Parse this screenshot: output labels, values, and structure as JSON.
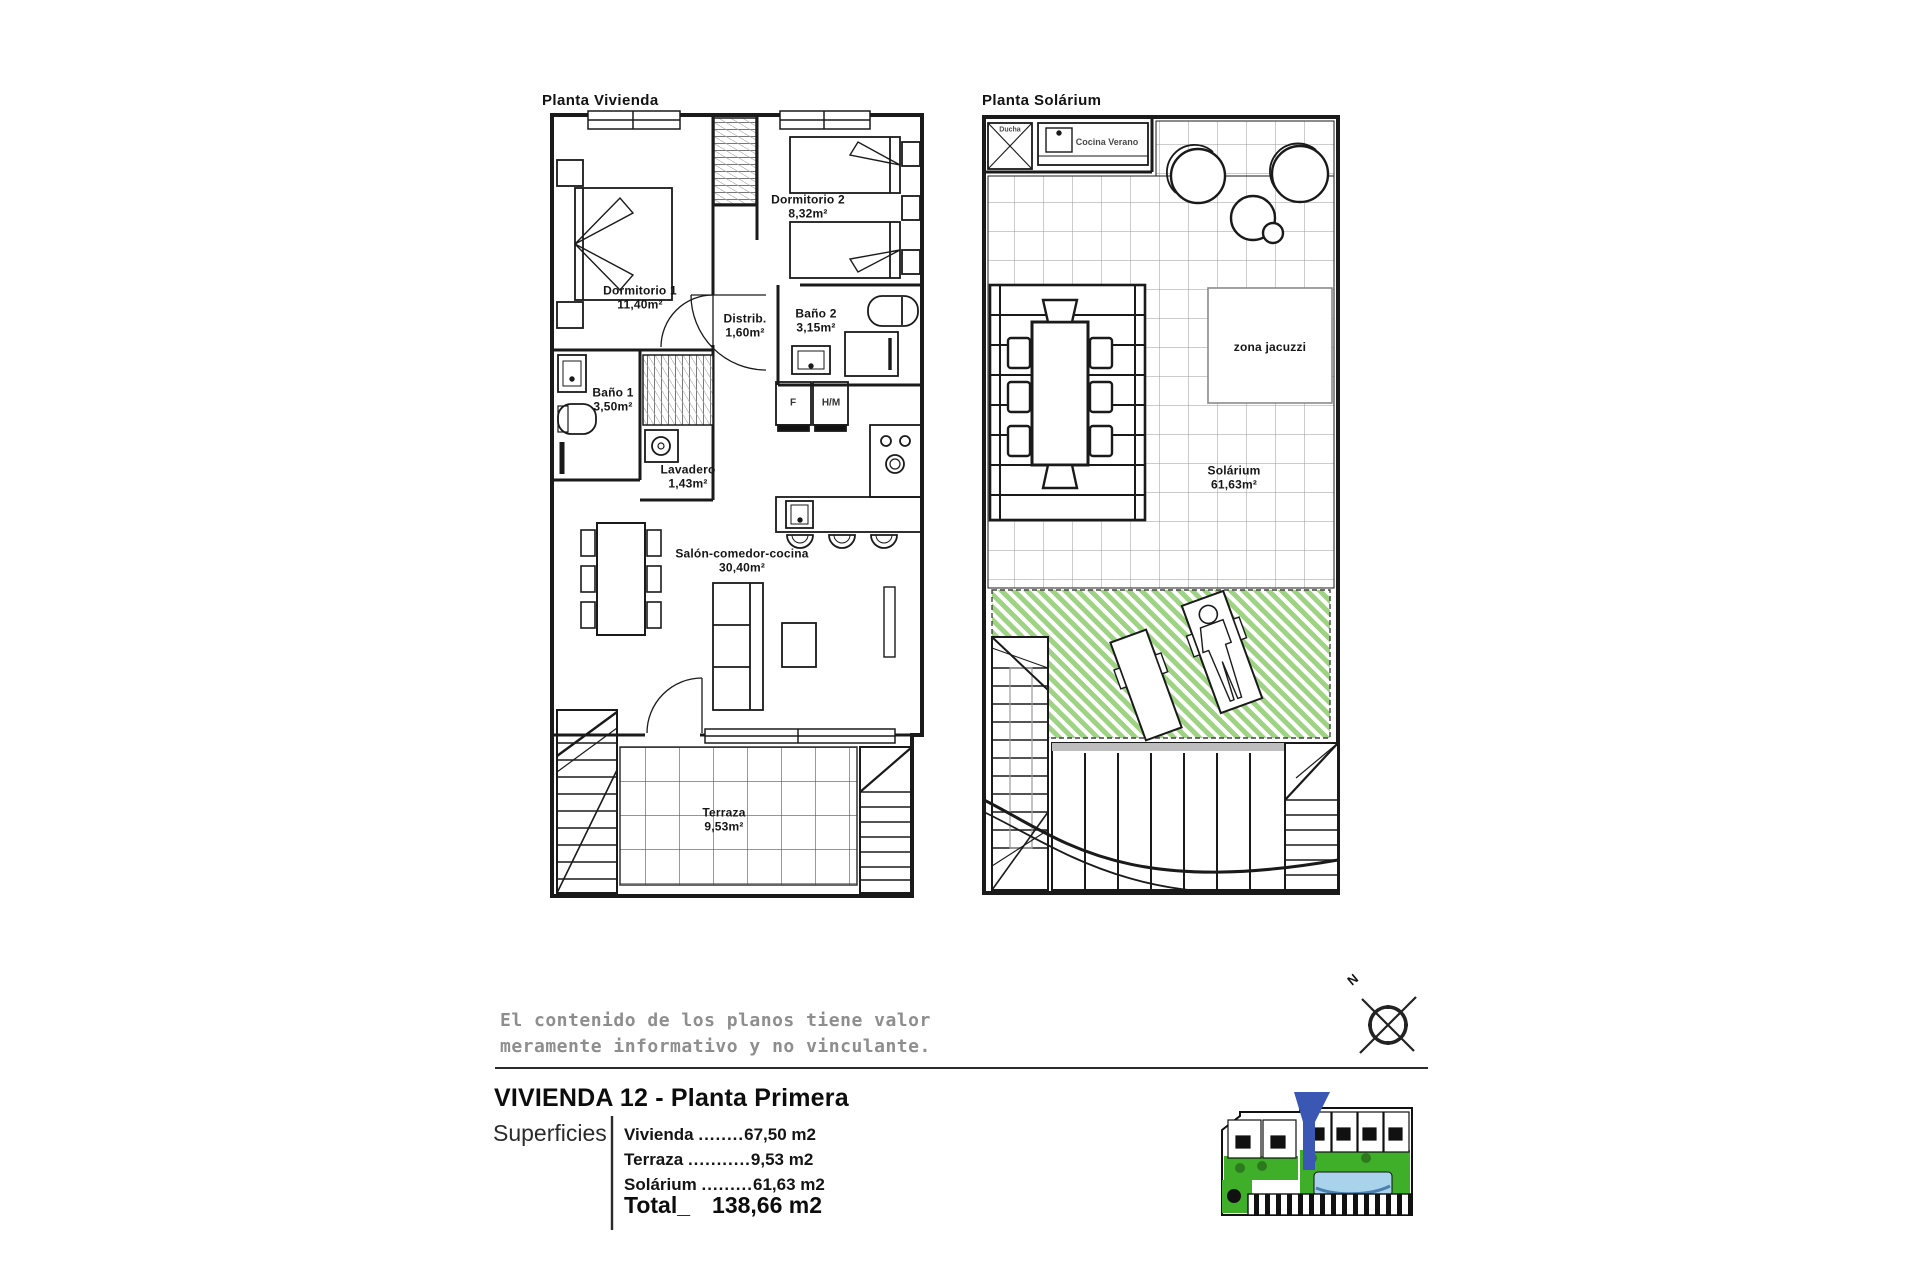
{
  "plan_vivienda": {
    "title": "Planta Vivienda",
    "rooms": {
      "dormitorio1": {
        "name": "Dormitorio 1",
        "area": "11,40m²"
      },
      "dormitorio2": {
        "name": "Dormitorio 2",
        "area": "8,32m²"
      },
      "distribuidor": {
        "name": "Distrib.",
        "area": "1,60m²"
      },
      "bano2": {
        "name": "Baño 2",
        "area": "3,15m²"
      },
      "bano1": {
        "name": "Baño 1",
        "area": "3,50m²"
      },
      "lavadero": {
        "name": "Lavadero",
        "area": "1,43m²"
      },
      "salon": {
        "name": "Salón-comedor-cocina",
        "area": "30,40m²"
      },
      "terraza": {
        "name": "Terraza",
        "area": "9,53m²"
      }
    },
    "appliances": {
      "fridge": "F",
      "oven": "H/M"
    }
  },
  "plan_solarium": {
    "title": "Planta Solárium",
    "labels": {
      "ducha": "Ducha",
      "cocina_verano": "Cocina Verano",
      "zona_jacuzzi": "zona jacuzzi",
      "solarium_name": "Solárium",
      "solarium_area": "61,63m²"
    }
  },
  "disclaimer": {
    "line1": "El contenido de los planos tiene valor",
    "line2": "meramente informativo y no vinculante."
  },
  "title_block": {
    "title": "VIVIENDA 12 - Planta Primera",
    "superficies_label": "Superficies",
    "rows": [
      {
        "label": "Vivienda ",
        "dots": "........",
        "value": "67,50 m2"
      },
      {
        "label": "Terraza ",
        "dots": "...........",
        "value": "9,53 m2"
      },
      {
        "label": "Solárium ",
        "dots": ".........",
        "value": "61,63 m2"
      }
    ],
    "total_label": "Total_",
    "total_value": "138,66 m2"
  },
  "compass": {
    "north_label": "N"
  },
  "colors": {
    "line": "#1a1a1a",
    "tile_grid": "#9a9a9a",
    "sun_area_green": "#9ed383",
    "site_green": "#3fae29",
    "bush_green": "#2d7a1e",
    "pool_blue": "#a9d3ea",
    "marker_blue": "#3a57b4",
    "disclaimer_gray": "#8e8e8e"
  }
}
